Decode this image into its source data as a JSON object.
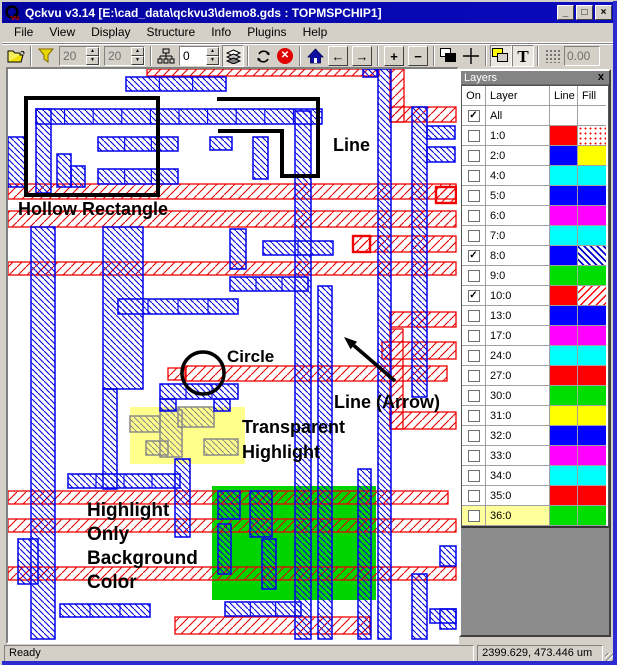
{
  "window": {
    "title": "Qckvu v3.14 [E:\\cad_data\\qckvu3\\demo8.gds : TOPMSPCHIP1]",
    "controls": {
      "minimize": "_",
      "maximize": "□",
      "close": "×"
    }
  },
  "menu": {
    "items": [
      "File",
      "View",
      "Display",
      "Structure",
      "Info",
      "Plugins",
      "Help"
    ]
  },
  "toolbar": {
    "spin_a": "20",
    "spin_b": "20",
    "spin_c": "0",
    "coord_display": "0.00",
    "icons": [
      "open-folder",
      "filter-funnel",
      "hierarchy-tree",
      "layer-stack",
      "rotate",
      "stop",
      "home",
      "arrow-left",
      "arrow-right",
      "zoom-in-plus",
      "zoom-out-minus",
      "overlap-squares-bw",
      "crosshair",
      "overlap-squares-yellow",
      "text-T",
      "grid-dots"
    ]
  },
  "canvas": {
    "colors": {
      "blue": "#0000F0",
      "red": "#F00000",
      "gray": "#8A8A8A",
      "black": "#000000",
      "yellow_highlight": "rgba(255,255,110,0.8)",
      "green_highlight": "#00D400"
    },
    "red_bands": [
      [
        139,
        0,
        232,
        7
      ],
      [
        382,
        0,
        14,
        53
      ],
      [
        382,
        38,
        66,
        15
      ],
      [
        0,
        115,
        448,
        15
      ],
      [
        0,
        142,
        448,
        16
      ],
      [
        0,
        193,
        448,
        13
      ],
      [
        345,
        167,
        103,
        16
      ],
      [
        160,
        299,
        18,
        12
      ],
      [
        177,
        297,
        262,
        15
      ],
      [
        382,
        243,
        66,
        15
      ],
      [
        374,
        273,
        74,
        17
      ],
      [
        382,
        260,
        13,
        100
      ],
      [
        382,
        343,
        66,
        17
      ],
      [
        0,
        422,
        440,
        13
      ],
      [
        0,
        450,
        448,
        13
      ],
      [
        0,
        498,
        448,
        13
      ],
      [
        167,
        548,
        195,
        17
      ]
    ],
    "red_boxes": [
      [
        345,
        167,
        17,
        16
      ],
      [
        428,
        118,
        20,
        16
      ]
    ],
    "blue_rects": [
      [
        118,
        8,
        100,
        14,
        1
      ],
      [
        355,
        0,
        14,
        8
      ],
      [
        28,
        40,
        286,
        15,
        1
      ],
      [
        28,
        40,
        15,
        84
      ],
      [
        90,
        68,
        80,
        14,
        1
      ],
      [
        90,
        100,
        80,
        15,
        1
      ],
      [
        49,
        85,
        14,
        33
      ],
      [
        63,
        97,
        14,
        21
      ],
      [
        202,
        68,
        22,
        13
      ],
      [
        245,
        68,
        15,
        42
      ],
      [
        0,
        68,
        18,
        50
      ],
      [
        23,
        158,
        24,
        412
      ],
      [
        95,
        158,
        40,
        162
      ],
      [
        110,
        230,
        120,
        15,
        1
      ],
      [
        95,
        320,
        14,
        100
      ],
      [
        152,
        315,
        78,
        15,
        1
      ],
      [
        152,
        330,
        16,
        12
      ],
      [
        206,
        330,
        16,
        12
      ],
      [
        167,
        390,
        15,
        78
      ],
      [
        60,
        405,
        112,
        14,
        1
      ],
      [
        10,
        470,
        20,
        45
      ],
      [
        52,
        535,
        90,
        13,
        1
      ],
      [
        222,
        160,
        16,
        40
      ],
      [
        222,
        208,
        78,
        14,
        1
      ],
      [
        255,
        172,
        70,
        14,
        1
      ],
      [
        287,
        42,
        16,
        528
      ],
      [
        310,
        217,
        14,
        353
      ],
      [
        350,
        400,
        13,
        170
      ],
      [
        370,
        0,
        13,
        570
      ],
      [
        404,
        38,
        15,
        290
      ],
      [
        404,
        505,
        15,
        65
      ],
      [
        419,
        57,
        28,
        13
      ],
      [
        419,
        78,
        28,
        15
      ],
      [
        210,
        422,
        22,
        28
      ],
      [
        242,
        422,
        22,
        46
      ],
      [
        210,
        455,
        13,
        50
      ],
      [
        254,
        470,
        14,
        50
      ],
      [
        217,
        533,
        76,
        14,
        1
      ],
      [
        422,
        540,
        26,
        14
      ],
      [
        432,
        477,
        16,
        20
      ],
      [
        432,
        540,
        16,
        20
      ]
    ],
    "gray_rects": [
      [
        122,
        347,
        30,
        16
      ],
      [
        152,
        341,
        22,
        47
      ],
      [
        170,
        338,
        36,
        20
      ],
      [
        196,
        370,
        34,
        16
      ],
      [
        138,
        372,
        22,
        14
      ]
    ],
    "highlights": {
      "yellow": [
        122,
        338,
        115,
        57
      ],
      "green": [
        204,
        417,
        164,
        114
      ]
    },
    "black_shapes": {
      "hollow_rect": [
        18,
        29,
        132,
        97
      ],
      "circle": [
        195,
        304,
        21
      ],
      "spiral": [
        [
          209,
          30
        ],
        [
          310,
          30
        ],
        [
          310,
          107
        ],
        [
          274,
          107
        ],
        [
          274,
          62
        ],
        [
          210,
          62
        ]
      ],
      "arrow": {
        "from": [
          387,
          312
        ],
        "to": [
          336,
          268
        ]
      }
    },
    "labels": [
      {
        "t": "Line",
        "x": 325,
        "y": 82,
        "s": 18
      },
      {
        "t": "Hollow Rectangle",
        "x": 10,
        "y": 146,
        "s": 18
      },
      {
        "t": "Circle",
        "x": 219,
        "y": 293,
        "s": 17
      },
      {
        "t": "Line (Arrow)",
        "x": 326,
        "y": 339,
        "s": 18
      },
      {
        "t": "Transparent",
        "x": 234,
        "y": 364,
        "s": 18
      },
      {
        "t": "Highlight",
        "x": 234,
        "y": 389,
        "s": 18
      },
      {
        "t": "Highlight",
        "x": 79,
        "y": 447,
        "s": 19
      },
      {
        "t": "Only",
        "x": 79,
        "y": 471,
        "s": 19
      },
      {
        "t": "Background",
        "x": 79,
        "y": 495,
        "s": 19
      },
      {
        "t": "Color",
        "x": 79,
        "y": 519,
        "s": 19
      }
    ]
  },
  "layers_panel": {
    "title": "Layers",
    "close": "x",
    "columns": [
      "On",
      "Layer",
      "Line",
      "Fill"
    ],
    "rows": [
      {
        "name": "All",
        "checked": true,
        "line": null,
        "fill": null
      },
      {
        "name": "1:0",
        "checked": false,
        "line": "#FF0000",
        "fill": "dots-red"
      },
      {
        "name": "2:0",
        "checked": false,
        "line": "#0000FF",
        "fill": "#FFFF00"
      },
      {
        "name": "4:0",
        "checked": false,
        "line": "#00FFFF",
        "fill": "#00FFFF"
      },
      {
        "name": "5:0",
        "checked": false,
        "line": "#0000FF",
        "fill": "#0000FF"
      },
      {
        "name": "6:0",
        "checked": false,
        "line": "#FF00FF",
        "fill": "#FF00FF"
      },
      {
        "name": "7:0",
        "checked": false,
        "line": "#00FFFF",
        "fill": "#00FFFF"
      },
      {
        "name": "8:0",
        "checked": true,
        "line": "#0000FF",
        "fill": "hatch-blue"
      },
      {
        "name": "9:0",
        "checked": false,
        "line": "#00DD00",
        "fill": "#00DD00"
      },
      {
        "name": "10:0",
        "checked": true,
        "line": "#FF0000",
        "fill": "hatch-red"
      },
      {
        "name": "13:0",
        "checked": false,
        "line": "#0000FF",
        "fill": "#0000FF"
      },
      {
        "name": "17:0",
        "checked": false,
        "line": "#FF00FF",
        "fill": "#FF00FF"
      },
      {
        "name": "24:0",
        "checked": false,
        "line": "#00FFFF",
        "fill": "#00FFFF"
      },
      {
        "name": "27:0",
        "checked": false,
        "line": "#FF0000",
        "fill": "#FF0000"
      },
      {
        "name": "30:0",
        "checked": false,
        "line": "#00DD00",
        "fill": "#00DD00"
      },
      {
        "name": "31:0",
        "checked": false,
        "line": "#FFFF00",
        "fill": "#FFFF00"
      },
      {
        "name": "32:0",
        "checked": false,
        "line": "#0000FF",
        "fill": "#0000FF"
      },
      {
        "name": "33:0",
        "checked": false,
        "line": "#FF00FF",
        "fill": "#FF00FF"
      },
      {
        "name": "34:0",
        "checked": false,
        "line": "#00FFFF",
        "fill": "#00FFFF"
      },
      {
        "name": "35:0",
        "checked": false,
        "line": "#FF0000",
        "fill": "#FF0000"
      },
      {
        "name": "36:0",
        "checked": false,
        "line": "#00DD00",
        "fill": "#00DD00",
        "selected": true
      }
    ]
  },
  "status_bar": {
    "left": "Ready",
    "right": "2399.629, 473.446 um"
  }
}
